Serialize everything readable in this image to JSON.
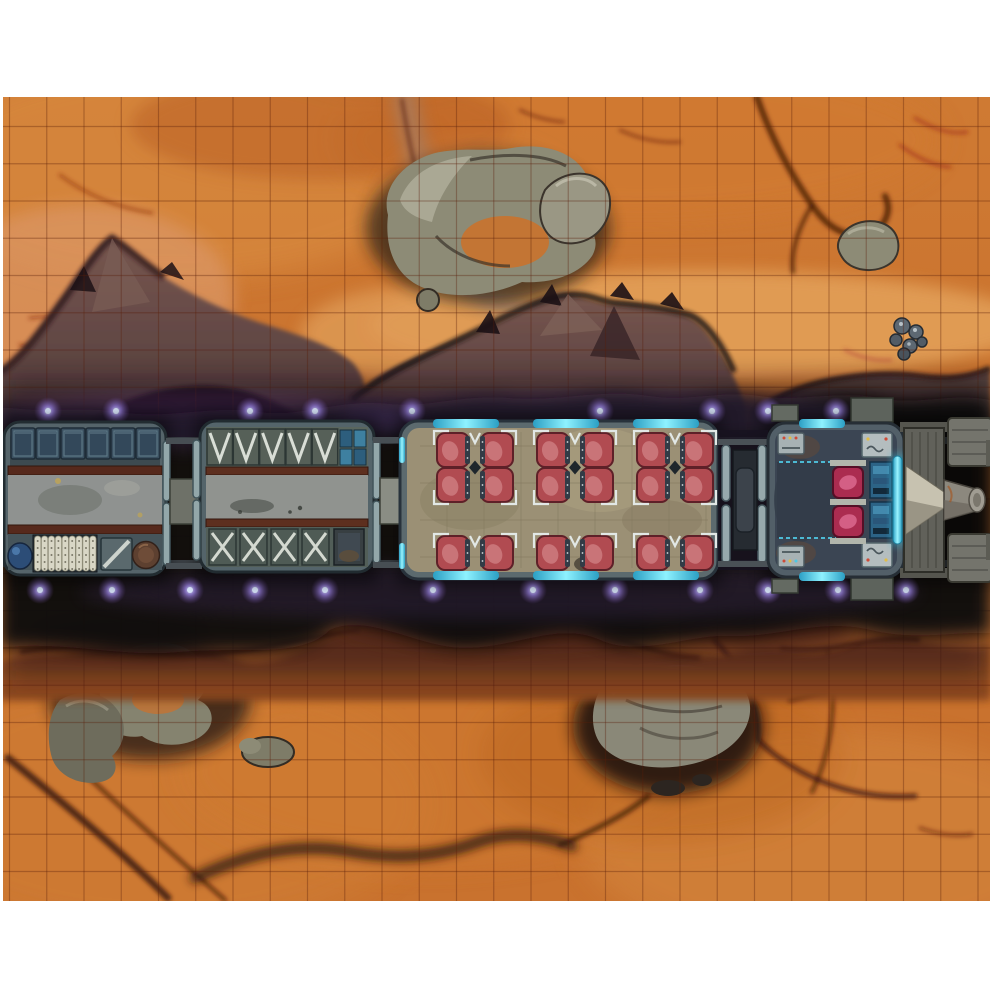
{
  "meta": {
    "kind": "printed tabletop battle map photo",
    "theme": "sci-fi hover train crossing a desert canyon, top-down",
    "page_margin_color": "#ffffff"
  },
  "map": {
    "x": 3,
    "y": 97,
    "width": 987,
    "height": 804
  },
  "grid": {
    "step": 37.25,
    "start_x": 9.5,
    "end_x": 988,
    "start_y": 126.5,
    "end_y": 900,
    "color": "#5a1e0a",
    "opacity": 0.34,
    "width": 1.2
  },
  "palette": {
    "terrain_base": "#c9722e",
    "terrain_light": "#e2a05c",
    "terrain_pale": "#e6a761",
    "terrain_rust": "#a14c20",
    "crack_dark": "#4a1a0b",
    "crack_red": "#a13018",
    "rock_gray": "#8d8b76",
    "rock_light": "#b2af9c",
    "rock_shadow": "#241c16",
    "mountain_mauve_top": "#77564f",
    "mountain_mauve_base": "#4a3335",
    "canyon_black": "#0c070b",
    "canyon_rust_wall": "#8a4722",
    "canyon_purple_tint": "#6a4a9a",
    "train_frame": "#55646a",
    "train_frame_stroke": "#222c31",
    "train_floor_gray": "#8f9290",
    "rail_rust": "#56291c",
    "crate_blue": "#3a4f5f",
    "cyan_accent": "#8ef2ff",
    "cyan_deep": "#2b9fc4",
    "seat_red": "#b14b51",
    "seat_red_light": "#d28186",
    "pilot_seat_magenta": "#ab2c50",
    "passenger_floor_tan": "#9b9075",
    "cockpit_deck": "#3b4553",
    "console_blue": "#2c6386",
    "glow_purple": "#9d86e8",
    "nose_gray": "#8c887e"
  },
  "terrain_features": [
    "top-middle rock mesa cluster",
    "top-right hooked crevice",
    "right boulder cluster",
    "left mauve mountain",
    "middle mauve mountain ridge",
    "right canyon rim",
    "central dark canyon",
    "bottom-left rock outcrops",
    "bottom-middle gray mesa",
    "bottom-left diagonal cracks",
    "bottom-middle winding crack"
  ],
  "train": {
    "track_y": [
      437,
      560
    ],
    "glow": {
      "top_y": 411,
      "bottom_y": 590,
      "top_x": [
        48,
        116,
        250,
        315,
        412,
        600,
        712,
        768,
        836
      ],
      "bottom_x": [
        40,
        112,
        190,
        255,
        325,
        433,
        533,
        615,
        700,
        768,
        838,
        906
      ]
    },
    "cargo_car": {
      "crates": {
        "x0": 11,
        "y": 428,
        "w": 24,
        "h": 31,
        "dx": 25,
        "count": 6
      },
      "cylinders": {
        "x0": 34.5,
        "y": 536,
        "w": 6.4,
        "h": 35,
        "dx": 6.9,
        "count": 9,
        "dot_rows": 5
      },
      "items": [
        "blue-sack",
        "pipe-rack",
        "striped-crate",
        "barrel"
      ]
    },
    "flatbed_car": {
      "ramps": {
        "x0": 207,
        "y": 429,
        "w": 25.5,
        "h": 36,
        "dx": 26.3,
        "count": 5
      },
      "braces": {
        "x0": 209,
        "y": 529,
        "w": 27,
        "h": 36,
        "dx": 31,
        "count": 4
      }
    },
    "passenger_car": {
      "cyan_strips": {
        "xs": [
          433,
          533,
          633
        ],
        "w": 66,
        "top_y": 419,
        "bottom_y": 571,
        "h": 9
      },
      "seats": {
        "cluster_x": [
          437,
          537,
          637
        ],
        "col_dx": 44,
        "seat_w": 32,
        "seat_h": 34,
        "top_rows_y": [
          433,
          468
        ],
        "bottom_rows_y": [
          536
        ],
        "total_seats": 18
      }
    },
    "cockpit_car": {
      "pilot_seats": {
        "x": 833,
        "w": 30,
        "h": 31,
        "ys": [
          467,
          506
        ]
      }
    }
  }
}
